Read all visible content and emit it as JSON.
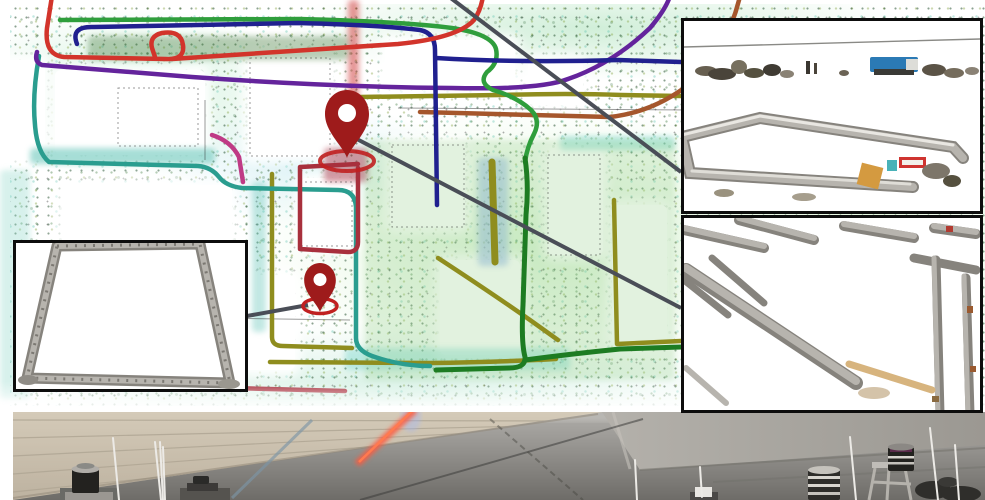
{
  "figure": {
    "kind": "multi-robot mapping figure",
    "regions": {
      "map": "aerial point-cloud map overlaid with colored robot trajectories and two location pins",
      "inset_top_right": "3D point-cloud close-up of a courtyard with parked vehicles and a blue truck",
      "inset_middle_right": "3D point-cloud close-up of crossing corridor walls with a tan pipe",
      "inset_bottom_left": "3D point-cloud close-up of a four-walled enclosure",
      "photo": "ground-level photo of sensor robots with lidars and antennas in a parking garage"
    }
  },
  "palette": {
    "leader_line": "#4a4e57",
    "pin": "#9e1b1b",
    "pin_ring": "#c02020",
    "inset_border": "#0d0d0d",
    "map_linework": "#222222"
  },
  "traj": {
    "red": "#d2342b",
    "navy": "#20208f",
    "green": "#2f9e3c",
    "dark_green": "#1d7c22",
    "purple": "#64249c",
    "teal": "#2a9d8f",
    "olive": "#8f8d1e",
    "maroon": "#a8303d",
    "brown": "#a5562c",
    "magenta": "#bf3a85"
  },
  "inset_items": {
    "truck_blue": "#2b7ab5",
    "sign_red": "#cf3430",
    "crate_cyan": "#49b2b8",
    "pallet_orange": "#d49a40",
    "pipe_tan": "#d7b47e",
    "wall_gray": "#b7b4ae",
    "wall_gray_dark": "#86837d"
  },
  "photo_colors": {
    "streak_orange": "#ff5a3c",
    "streak_core": "#ff7a50",
    "wall_beige": "#cfc5b3",
    "wall_concrete": "#aaa7a1",
    "floor_gray": "#8e8c88",
    "antenna_white": "#eceae6",
    "lidar_dark": "#23221f"
  }
}
